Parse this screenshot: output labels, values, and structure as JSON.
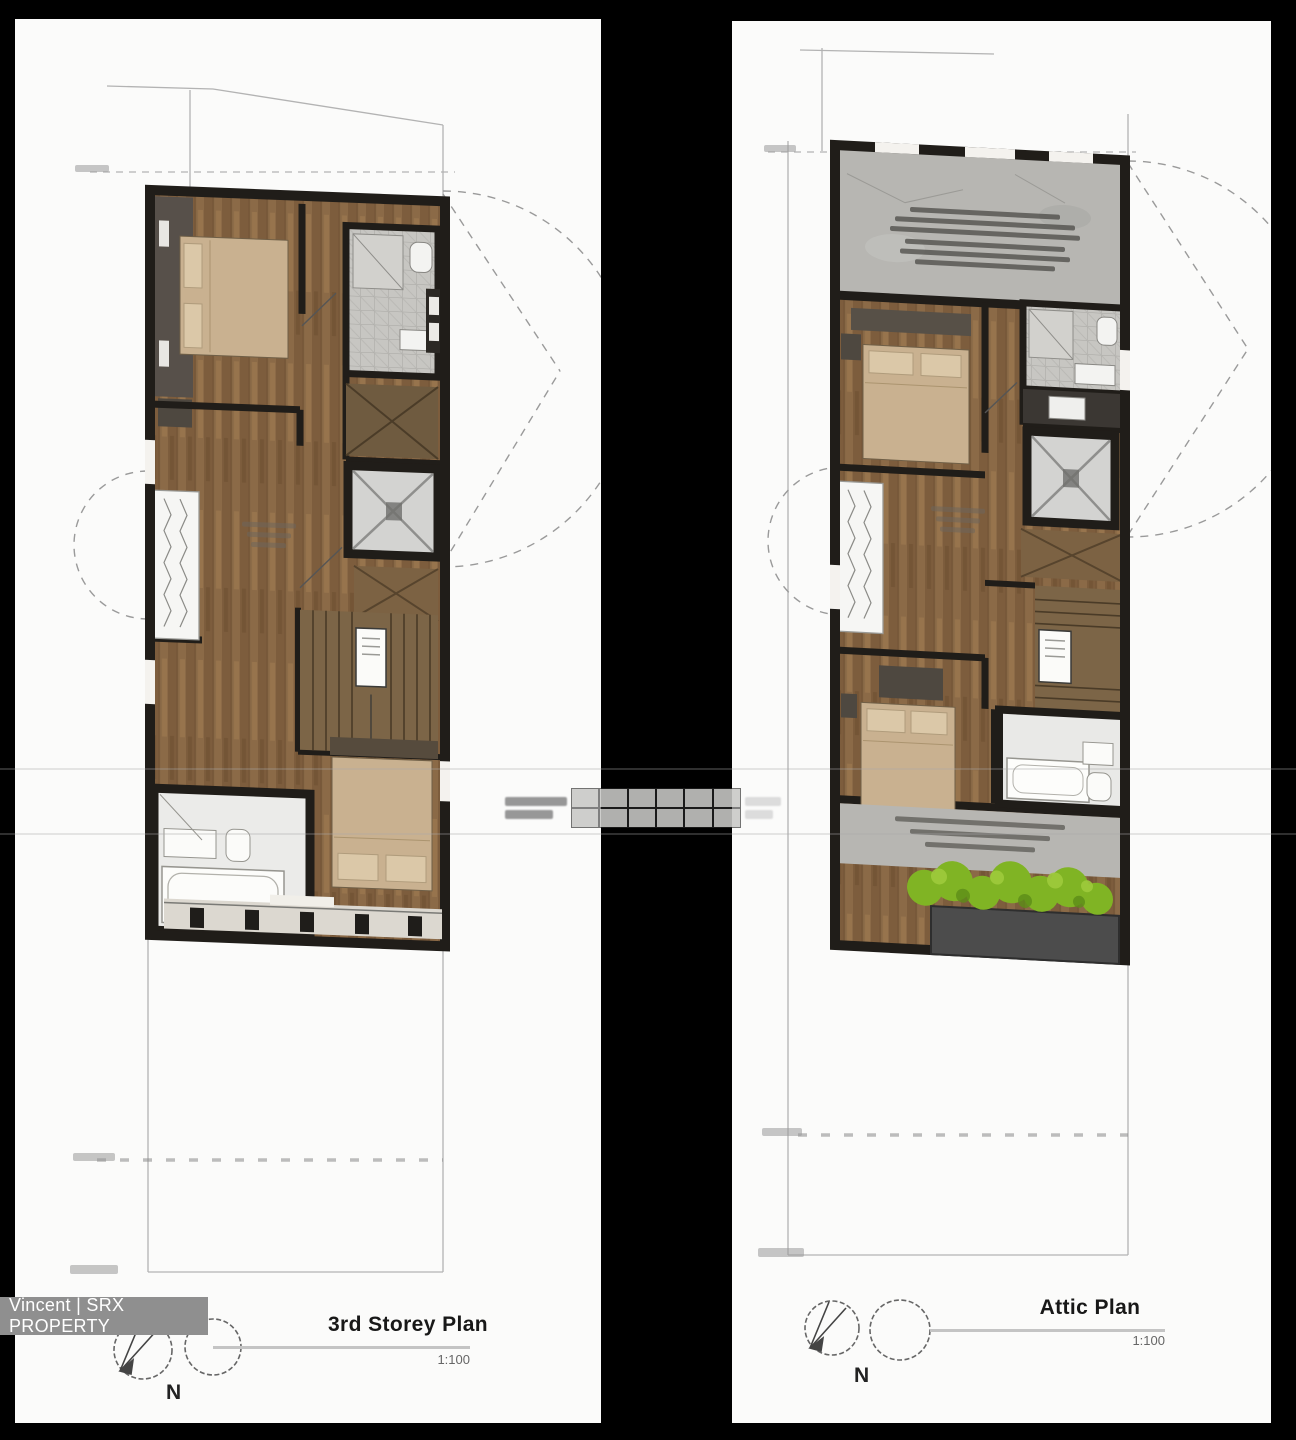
{
  "plans": {
    "left": {
      "title": "3rd Storey Plan",
      "scale": "1:100",
      "compass": "N"
    },
    "right": {
      "title": "Attic Plan",
      "scale": "1:100",
      "compass": "N"
    }
  },
  "watermark": {
    "label": "Vincent | SRX PROPERTY"
  },
  "colors": {
    "background": "#000000",
    "panel": "#fbfbfa",
    "wall": "#201d19",
    "bed": "#c9b190",
    "lift": "#d3d3d1",
    "tile": "#c7c6c2",
    "terrace": "#b7b6b2",
    "planter_green": "#80b424",
    "planter_box": "#4c4c4c",
    "boundary_line": "#b3b3b3",
    "watermark_bg": "#8f8f8f",
    "title_text": "#181818",
    "scale_text": "#666666"
  }
}
